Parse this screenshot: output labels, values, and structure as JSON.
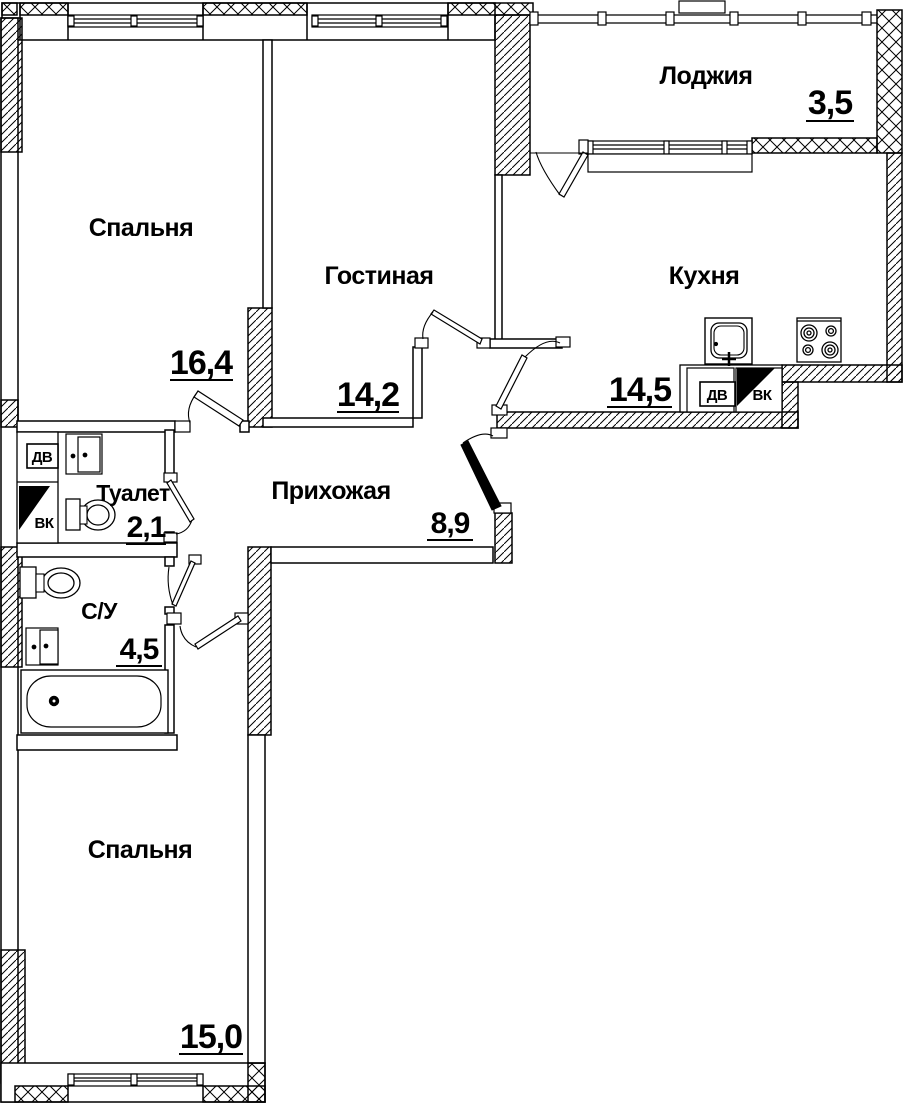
{
  "plan": {
    "rooms": [
      {
        "name": "Спальня",
        "area": "16,4"
      },
      {
        "name": "Гостиная",
        "area": "14,2"
      },
      {
        "name": "Лоджия",
        "area": "3,5"
      },
      {
        "name": "Кухня",
        "area": "14,5"
      },
      {
        "name": "Туалет",
        "area": "2,1"
      },
      {
        "name": "Прихожая",
        "area": "8,9"
      },
      {
        "name": "С/У",
        "area": "4,5"
      },
      {
        "name": "Спальня",
        "area": "15,0"
      }
    ],
    "vents": {
      "dv": "ДВ",
      "vk": "ВК"
    },
    "colors": {
      "line": "#000000",
      "background": "#ffffff"
    }
  }
}
